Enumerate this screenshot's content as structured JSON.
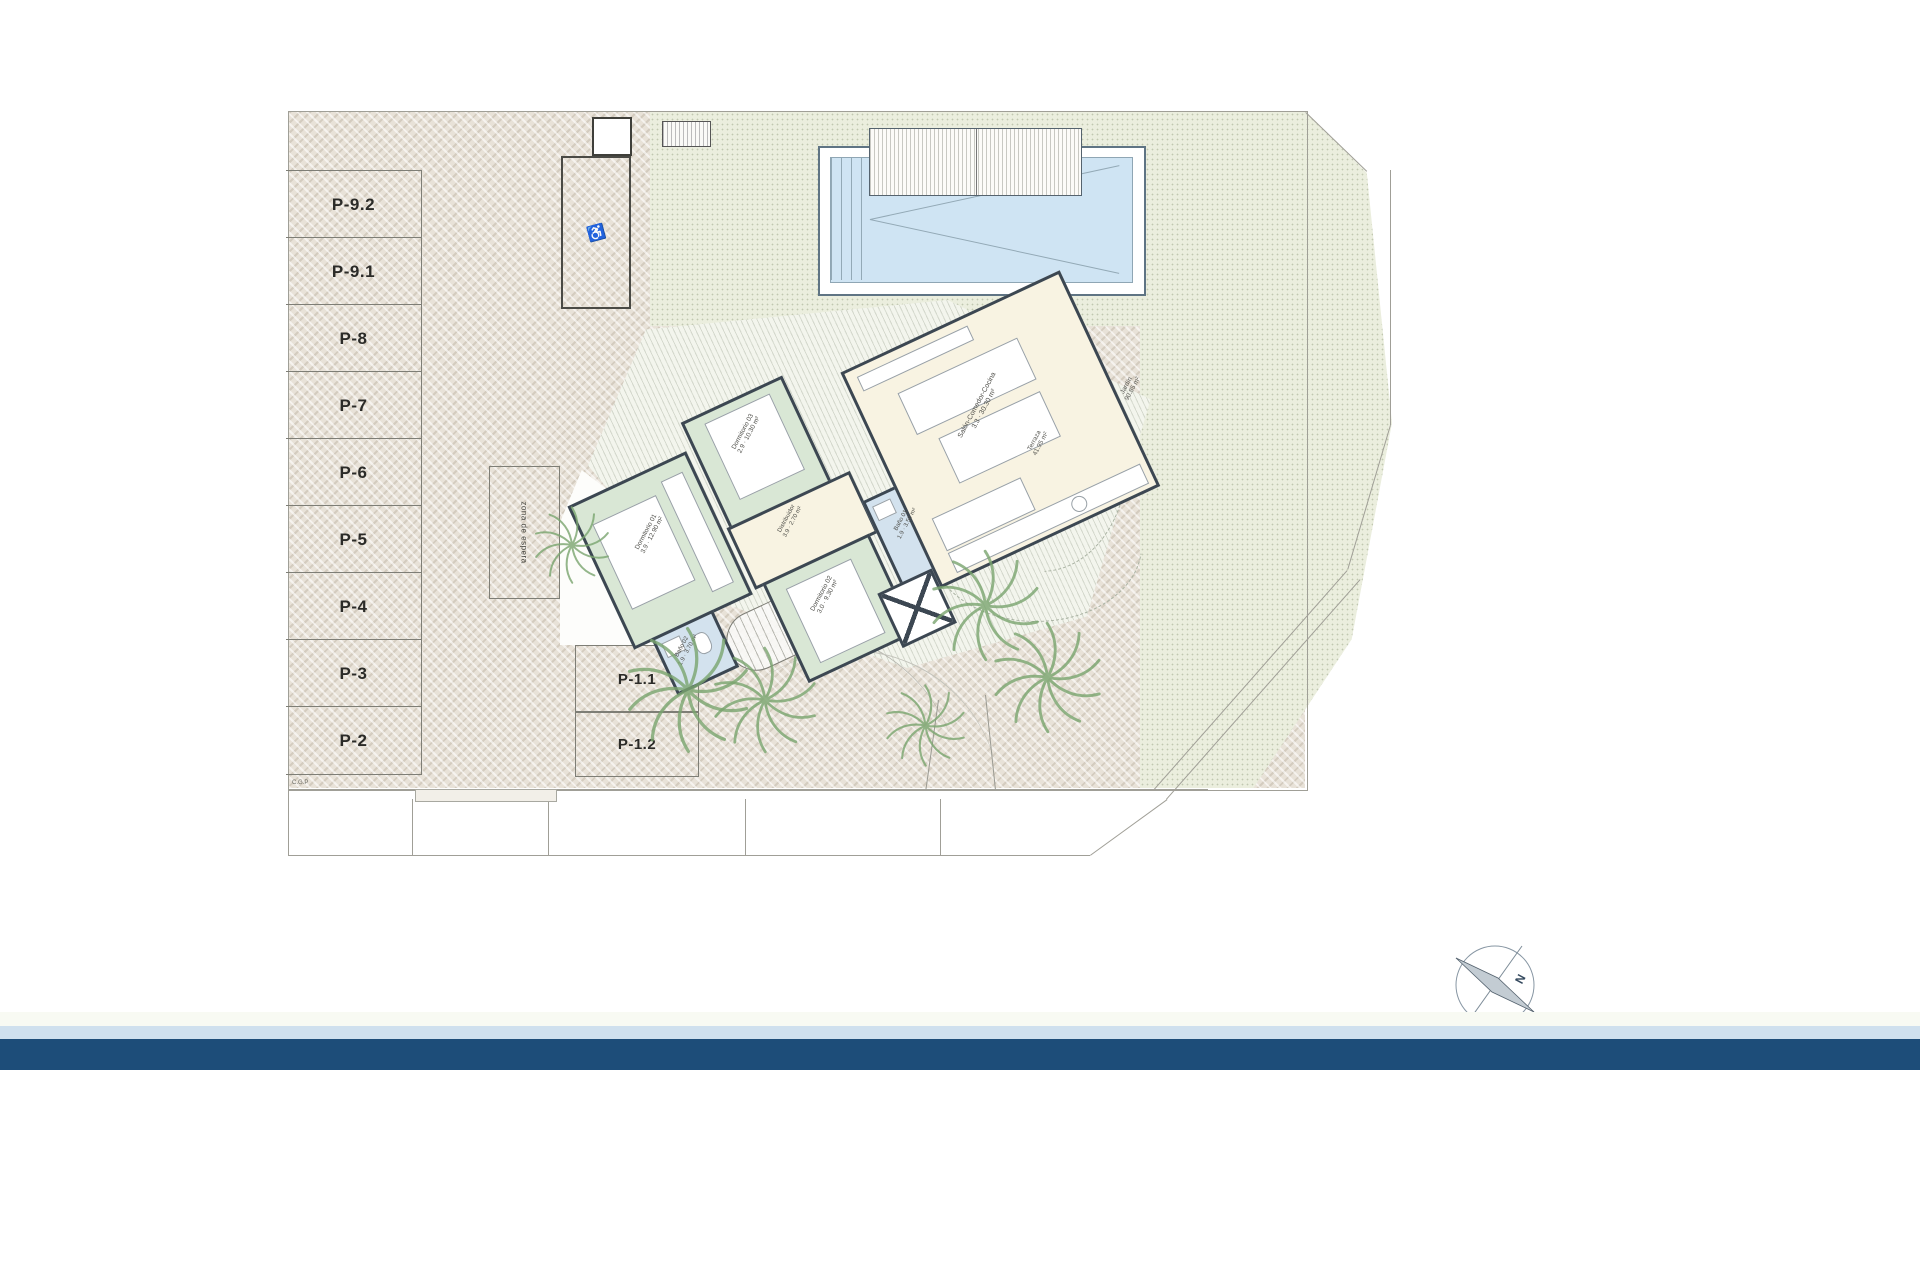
{
  "plan": {
    "parking_spaces": [
      "P-9.2",
      "P-9.1",
      "P-8",
      "P-7",
      "P-6",
      "P-5",
      "P-4",
      "P-3",
      "P-2"
    ],
    "parking_front": [
      "P-1.1",
      "P-1.2"
    ],
    "waiting_zone_label": "zona de espera",
    "corner_label": "C.G.P",
    "accessible_icon": "wheelchair-accessible-parking",
    "rooms": [
      {
        "name": "Dormitorio 01",
        "dims": "3.9 · 12.90 m²"
      },
      {
        "name": "Dormitorio 03",
        "dims": "2.9 · 10.30 m²"
      },
      {
        "name": "Dormitorio 02",
        "dims": "3.0 · 9.30 m²"
      },
      {
        "name": "Baño 01",
        "dims": "1.9 · 3.50 m²"
      },
      {
        "name": "Baño 02",
        "dims": "1.9 · 3.70 m²"
      },
      {
        "name": "Distribuidor",
        "dims": "3.9 · 2.70 m²"
      },
      {
        "name": "Salón-Comedor-Cocina",
        "dims": "3.3 · 30.30 m²"
      }
    ],
    "annotations": {
      "terraza": {
        "name": "Terraza",
        "area": "41.95 m²"
      },
      "jardin": {
        "name": "Jardín",
        "area": "90.85 m²"
      }
    },
    "compass": {
      "north_label": "N"
    }
  },
  "colors": {
    "wall": "#3c4752",
    "bedroom_fill": "#d9e7d5",
    "bath_fill": "#d3e2ee",
    "living_fill": "#f8f3e2",
    "pool_water": "#cfe4f3",
    "footer_navy": "#1d4d79",
    "footer_lightblue": "#cfe0ee",
    "vegetation": "#7aa56f"
  }
}
